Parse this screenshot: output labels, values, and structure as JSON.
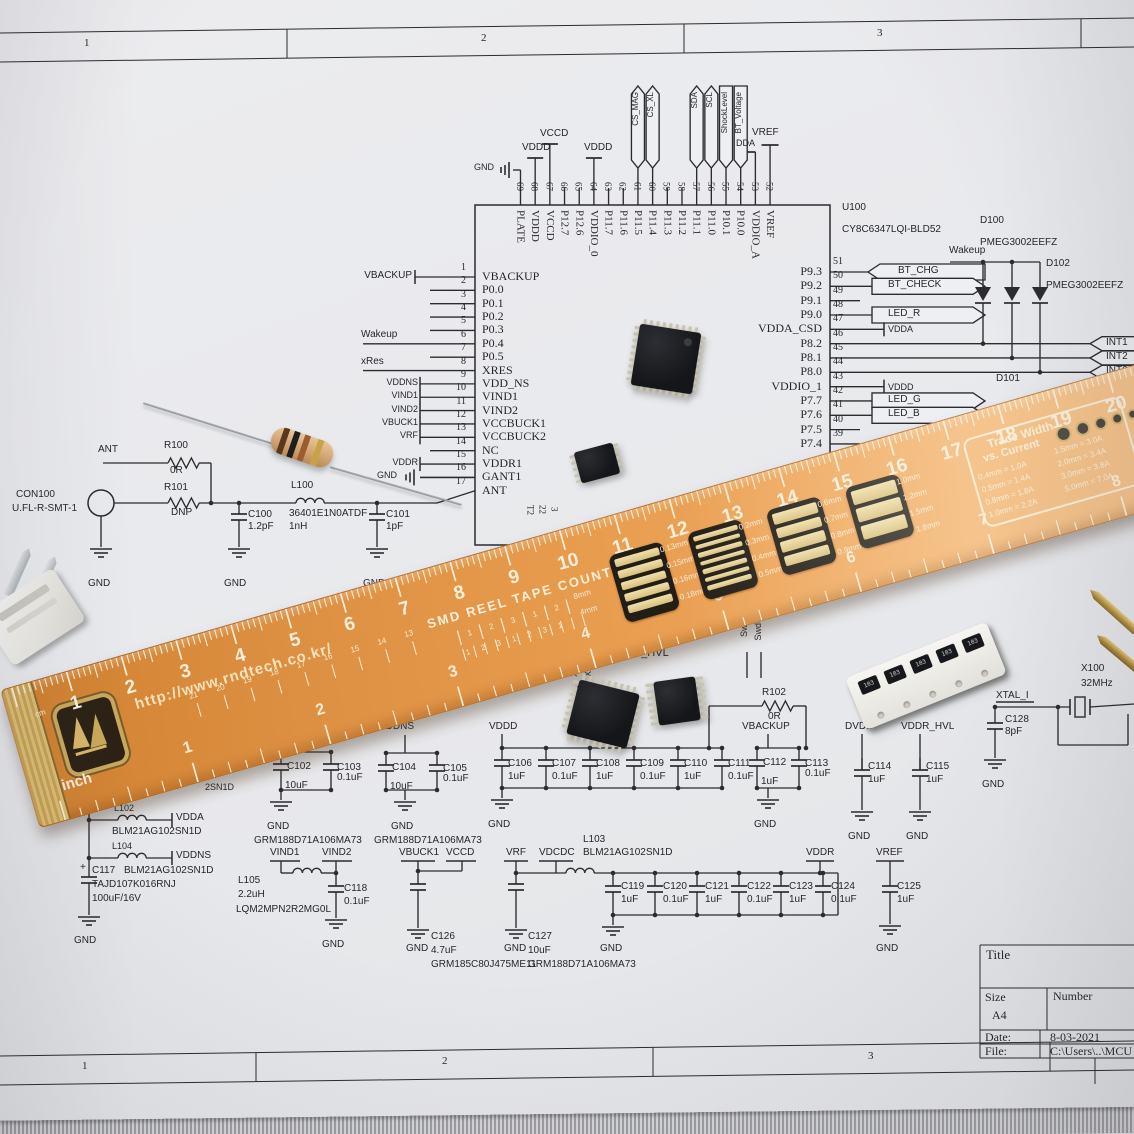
{
  "gnd": "GND",
  "sheet": {
    "zones_top": [
      "1",
      "2",
      "3"
    ],
    "zones_bottom": [
      "1",
      "2",
      "3"
    ],
    "title_block": {
      "title": "Title",
      "size_label": "Size",
      "size": "A4",
      "number_label": "Number",
      "date_label": "Date:",
      "date": "8-03-2021",
      "file_label": "File:",
      "file": "C:\\Users\\..\\MCU"
    }
  },
  "mcu": {
    "ref": "U100",
    "part": "CY8C6347LQI-BLD52",
    "top_pins": [
      [
        "69",
        "PLATE"
      ],
      [
        "68",
        "VDDD"
      ],
      [
        "67",
        "VCCD"
      ],
      [
        "66",
        "P12.7"
      ],
      [
        "65",
        "P12.6"
      ],
      [
        "64",
        "VDDIO_0"
      ],
      [
        "63",
        "P11.7"
      ],
      [
        "62",
        "P11.6"
      ],
      [
        "61",
        "P11.5"
      ],
      [
        "60",
        "P11.4"
      ],
      [
        "59",
        "P11.3"
      ],
      [
        "58",
        "P11.2"
      ],
      [
        "57",
        "P11.1"
      ],
      [
        "56",
        "P11.0"
      ],
      [
        "55",
        "P10.1"
      ],
      [
        "54",
        "P10.0"
      ],
      [
        "53",
        "VDDIO_A"
      ],
      [
        "52",
        "VREF"
      ]
    ],
    "left_pins": [
      [
        "1",
        "VBACKUP"
      ],
      [
        "2",
        "P0.0"
      ],
      [
        "3",
        "P0.1"
      ],
      [
        "4",
        "P0.2"
      ],
      [
        "5",
        "P0.3"
      ],
      [
        "6",
        "P0.4"
      ],
      [
        "7",
        "P0.5"
      ],
      [
        "8",
        "XRES"
      ],
      [
        "9",
        "VDD_NS"
      ],
      [
        "10",
        "VIND1"
      ],
      [
        "11",
        "VIND2"
      ],
      [
        "12",
        "VCCBUCK1"
      ],
      [
        "13",
        "VCCBUCK2"
      ],
      [
        "14",
        "NC"
      ],
      [
        "15",
        "VDDR1"
      ],
      [
        "16",
        "GANT1"
      ],
      [
        "17",
        "ANT"
      ]
    ],
    "right_pins": [
      [
        "51",
        "P9.3"
      ],
      [
        "50",
        "P9.2"
      ],
      [
        "49",
        "P9.1"
      ],
      [
        "48",
        "P9.0"
      ],
      [
        "47",
        "VDDA_CSD"
      ],
      [
        "46",
        "P8.2"
      ],
      [
        "45",
        "P8.1"
      ],
      [
        "44",
        "P8.0"
      ],
      [
        "43",
        "VDDIO_1"
      ],
      [
        "42",
        "P7.7"
      ],
      [
        "41",
        "P7.6"
      ],
      [
        "40",
        "P7.5"
      ],
      [
        "39",
        "P7.4"
      ]
    ],
    "bottom_fragments": [
      "T2",
      "22",
      "3"
    ]
  },
  "top_nets": {
    "vddd1": "VDDD",
    "vccd": "VCCD",
    "vddd2": "VDDD",
    "flags": [
      "CS_MAG",
      "CS_XL",
      "SDA",
      "SCL",
      "ShockLevel",
      "BT_Voltage"
    ],
    "vdda_partial": "DDA",
    "vref": "VREF"
  },
  "left_nets": {
    "vbackup": "VBACKUP",
    "wakeup": "Wakeup",
    "xres": "xRes",
    "vddns": "VDDNS",
    "vind1": "VIND1",
    "vind2": "VIND2",
    "vbuck1": "VBUCK1",
    "vrf": "VRF",
    "vddr": "VDDR"
  },
  "right_nets": {
    "bt_chg": "BT_CHG",
    "bt_check": "BT_CHECK",
    "led_r": "LED_R",
    "vdda": "VDDA",
    "vddd": "VDDD",
    "led_g": "LED_G",
    "led_b": "LED_B",
    "ints": [
      "INT1",
      "INT2",
      "INT3"
    ],
    "wakeup": "Wakeup"
  },
  "diodes": {
    "d100_ref": "D100",
    "d100_part": "PMEG3002EEFZ",
    "d102_ref": "D102",
    "d102_part": "PMEG3002EEFZ",
    "d101_ref": "D101"
  },
  "rf": {
    "ant": "ANT",
    "con_ref": "CON100",
    "con_part": "U.FL-R-SMT-1",
    "r100": [
      "R100",
      "0R"
    ],
    "r101": [
      "R101",
      "DNP"
    ],
    "c100": [
      "C100",
      "1.2pF"
    ],
    "l100": [
      "L100",
      "36401E1N0ATDF",
      "1nH"
    ],
    "c101": [
      "C101",
      "1pF"
    ]
  },
  "cap_banks": [
    {
      "net": "",
      "caps": [
        [
          "C102",
          "10uF"
        ],
        [
          "C103",
          "0.1uF"
        ]
      ]
    },
    {
      "net": "VDDNS",
      "caps": [
        [
          "C104",
          "10uF"
        ],
        [
          "C105",
          "0.1uF"
        ]
      ]
    },
    {
      "net": "VDDD",
      "caps": [
        [
          "C106",
          "1uF"
        ],
        [
          "C107",
          "0.1uF"
        ],
        [
          "C108",
          "1uF"
        ],
        [
          "C109",
          "0.1uF"
        ],
        [
          "C110",
          "1uF"
        ],
        [
          "C111",
          "0.1uF"
        ]
      ]
    },
    {
      "net": "VBACKUP",
      "caps": [
        [
          "C112",
          "1uF"
        ],
        [
          "C113",
          "0.1uF"
        ]
      ]
    },
    {
      "net": "DVDD",
      "caps": [
        [
          "C114",
          "1uF"
        ]
      ]
    },
    {
      "net": "VDDR_HVL",
      "caps": [
        [
          "C115",
          "1uF"
        ]
      ]
    }
  ],
  "r102": [
    "R102",
    "0R"
  ],
  "notes": {
    "grm1": "GRM188D71A106MA73",
    "grm2": "GRM188D71A106MA73"
  },
  "bottom_left": {
    "l102": [
      "L102",
      "BLM21AG102SN1D"
    ],
    "vdda": "VDDA",
    "l104": [
      "L104",
      "BLM21AG102SN1D"
    ],
    "vddns": "VDDNS",
    "polarity": "+",
    "c117": [
      "C117",
      "TAJD107K016RNJ",
      "100uF/16V"
    ],
    "partial": "2SN1D"
  },
  "vind_filter": {
    "vind1": "VIND1",
    "vind2": "VIND2",
    "l105": [
      "L105",
      "2.2uH",
      "LQM2MPN2R2MG0L"
    ],
    "c118": [
      "C118",
      "0.1uF"
    ]
  },
  "buck": {
    "vbuck1": "VBUCK1",
    "vccd": "VCCD",
    "c126": [
      "C126",
      "4.7uF",
      "GRM185C80J475ME11"
    ]
  },
  "vrf_filter": {
    "vrf": "VRF",
    "vdcdc": "VDCDC",
    "l103": [
      "L103",
      "BLM21AG102SN1D"
    ],
    "c127": [
      "C127",
      "10uF",
      "GRM188D71A106MA73"
    ],
    "caps": [
      [
        "C119",
        "1uF"
      ],
      [
        "C120",
        "0.1uF"
      ],
      [
        "C121",
        "1uF"
      ],
      [
        "C122",
        "0.1uF"
      ],
      [
        "C123",
        "1uF"
      ],
      [
        "C124",
        "0.1uF"
      ]
    ],
    "vddr": "VDDR"
  },
  "vref_cap": {
    "vref": "VREF",
    "c125": [
      "C125",
      "1uF"
    ]
  },
  "crystal": {
    "xtal_i": "XTAL_I",
    "ref": "X100",
    "freq": "32MHz",
    "c128": [
      "C128",
      "8pF"
    ],
    "swdio": "SwdIo",
    "swdck": "SwdCk",
    "vddr_hvl": "VDDR_HVL",
    "xta_fragments": [
      "XTA",
      "XTA"
    ]
  },
  "ruler": {
    "brand_url": "http://www.rndtech.co.kr/",
    "counter_title": "SMD REEL TAPE COUNTER",
    "cm_label": "cm",
    "inch_label": "inch",
    "pitch8": "8mm",
    "pitch4": "4mm",
    "cm_numbers": [
      "1",
      "2",
      "3",
      "4",
      "5",
      "6",
      "7",
      "8",
      "9",
      "10",
      "11",
      "12",
      "13",
      "14",
      "15",
      "16",
      "17",
      "18",
      "19",
      "20"
    ],
    "inch_numbers": [
      "1",
      "2",
      "3",
      "4",
      "5",
      "6",
      "7",
      "8"
    ],
    "reverse_numbers": [
      "21",
      "20",
      "19",
      "18",
      "17",
      "16",
      "15",
      "14",
      "13"
    ],
    "counter_row1": [
      "1",
      "2",
      "3",
      "1",
      "2"
    ],
    "counter_row2": [
      "1",
      "2",
      "3",
      "1",
      "2",
      "3",
      "1"
    ],
    "pad_groups": [
      [
        "0.13mm",
        "0.15mm",
        "0.16mm",
        "0.18mm"
      ],
      [
        "0.2mm",
        "0.3mm",
        "0.4mm",
        "0.5mm"
      ],
      [
        "0.6mm",
        "0.7mm",
        "0.8mm",
        "0.9mm"
      ],
      [
        "1.0mm",
        "1.2mm",
        "1.5mm",
        "1.8mm"
      ]
    ],
    "trace_table": {
      "title1": "Trace Width",
      "title2": "vs. Current",
      "left": [
        "0.4mm = 1.0A",
        "0.5mm = 1.4A",
        "0.8mm = 1.8A",
        "1.0mm = 2.2A"
      ],
      "right": [
        "1.5mm = 3.0A",
        "2.0mm = 3.4A",
        "3.0mm = 3.8A",
        "5.0mm = 7.0A"
      ]
    }
  },
  "smd_strip": {
    "marking": "103"
  }
}
